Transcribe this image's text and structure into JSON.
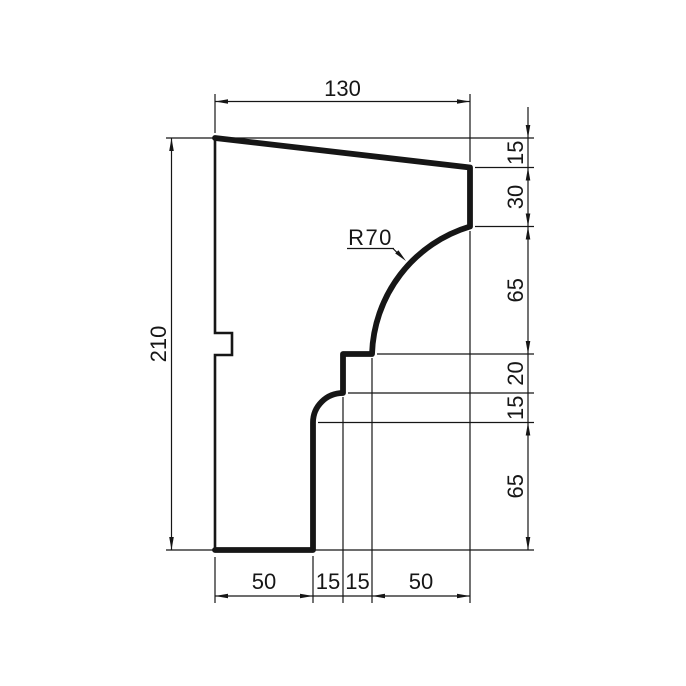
{
  "drawing": {
    "description": "Cornice molding profile section with chained dimensions",
    "background_color": "#ffffff",
    "line_color": "#161616",
    "dimensions": {
      "top_width": "130",
      "left_height": "210",
      "radius_label": "R70",
      "right_chain": [
        "15",
        "30",
        "65",
        "20",
        "15",
        "65"
      ],
      "bottom_chain": [
        "50",
        "15",
        "15",
        "50"
      ]
    }
  }
}
